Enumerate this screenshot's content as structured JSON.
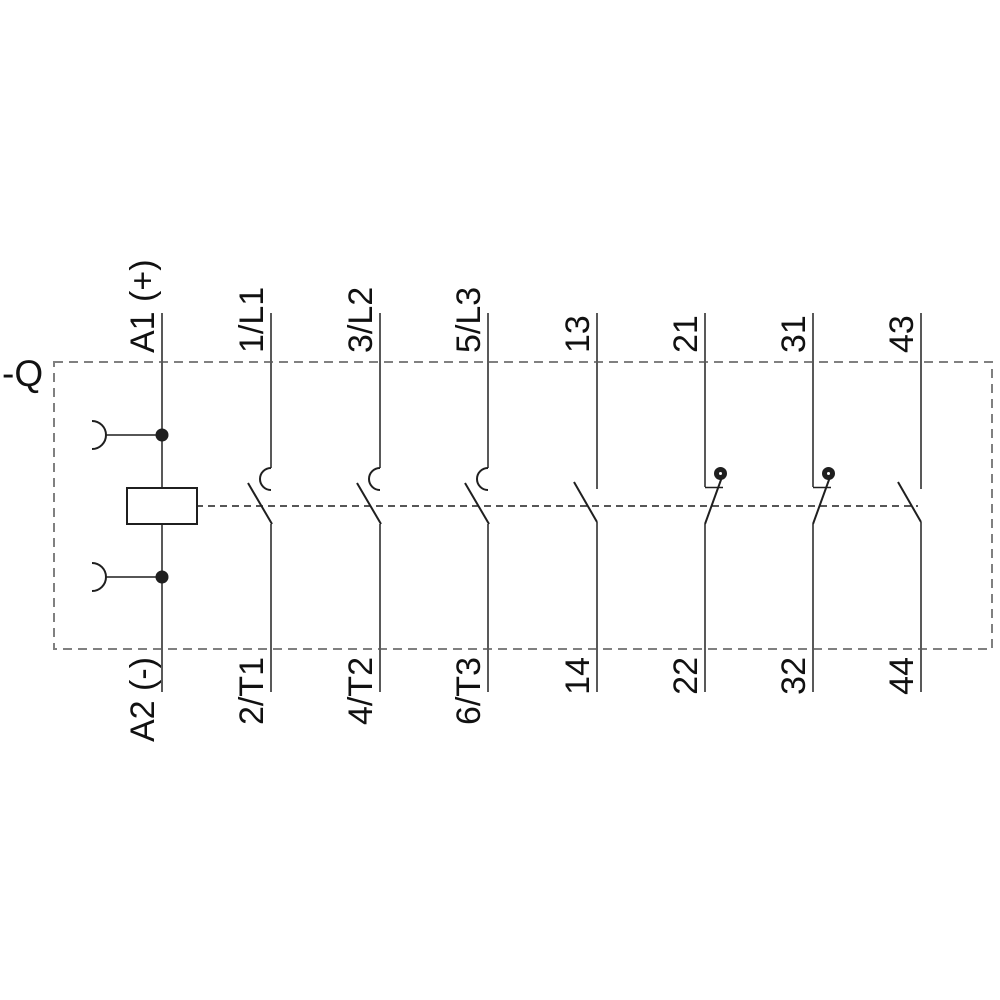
{
  "diagram": {
    "device_label": "-Q",
    "description": "Contactor wiring schematic with coil and 7 contact poles in a dashed enclosure",
    "colors": {
      "background": "#ffffff",
      "terminal_line": "#595959",
      "symbol": "#1f1f1f",
      "enclosure_dash": "#808080",
      "label_text": "#111111"
    },
    "coil": {
      "top_label": "A1 (+)",
      "bottom_label": "A2 (-)",
      "element": "coil-box"
    },
    "poles": [
      {
        "top_label": "1/L1",
        "bottom_label": "2/T1",
        "type": "main-no"
      },
      {
        "top_label": "3/L2",
        "bottom_label": "4/T2",
        "type": "main-no"
      },
      {
        "top_label": "5/L3",
        "bottom_label": "6/T3",
        "type": "main-no"
      },
      {
        "top_label": "13",
        "bottom_label": "14",
        "type": "aux-no"
      },
      {
        "top_label": "21",
        "bottom_label": "22",
        "type": "aux-nc"
      },
      {
        "top_label": "31",
        "bottom_label": "32",
        "type": "aux-nc"
      },
      {
        "top_label": "43",
        "bottom_label": "44",
        "type": "aux-no"
      }
    ]
  }
}
